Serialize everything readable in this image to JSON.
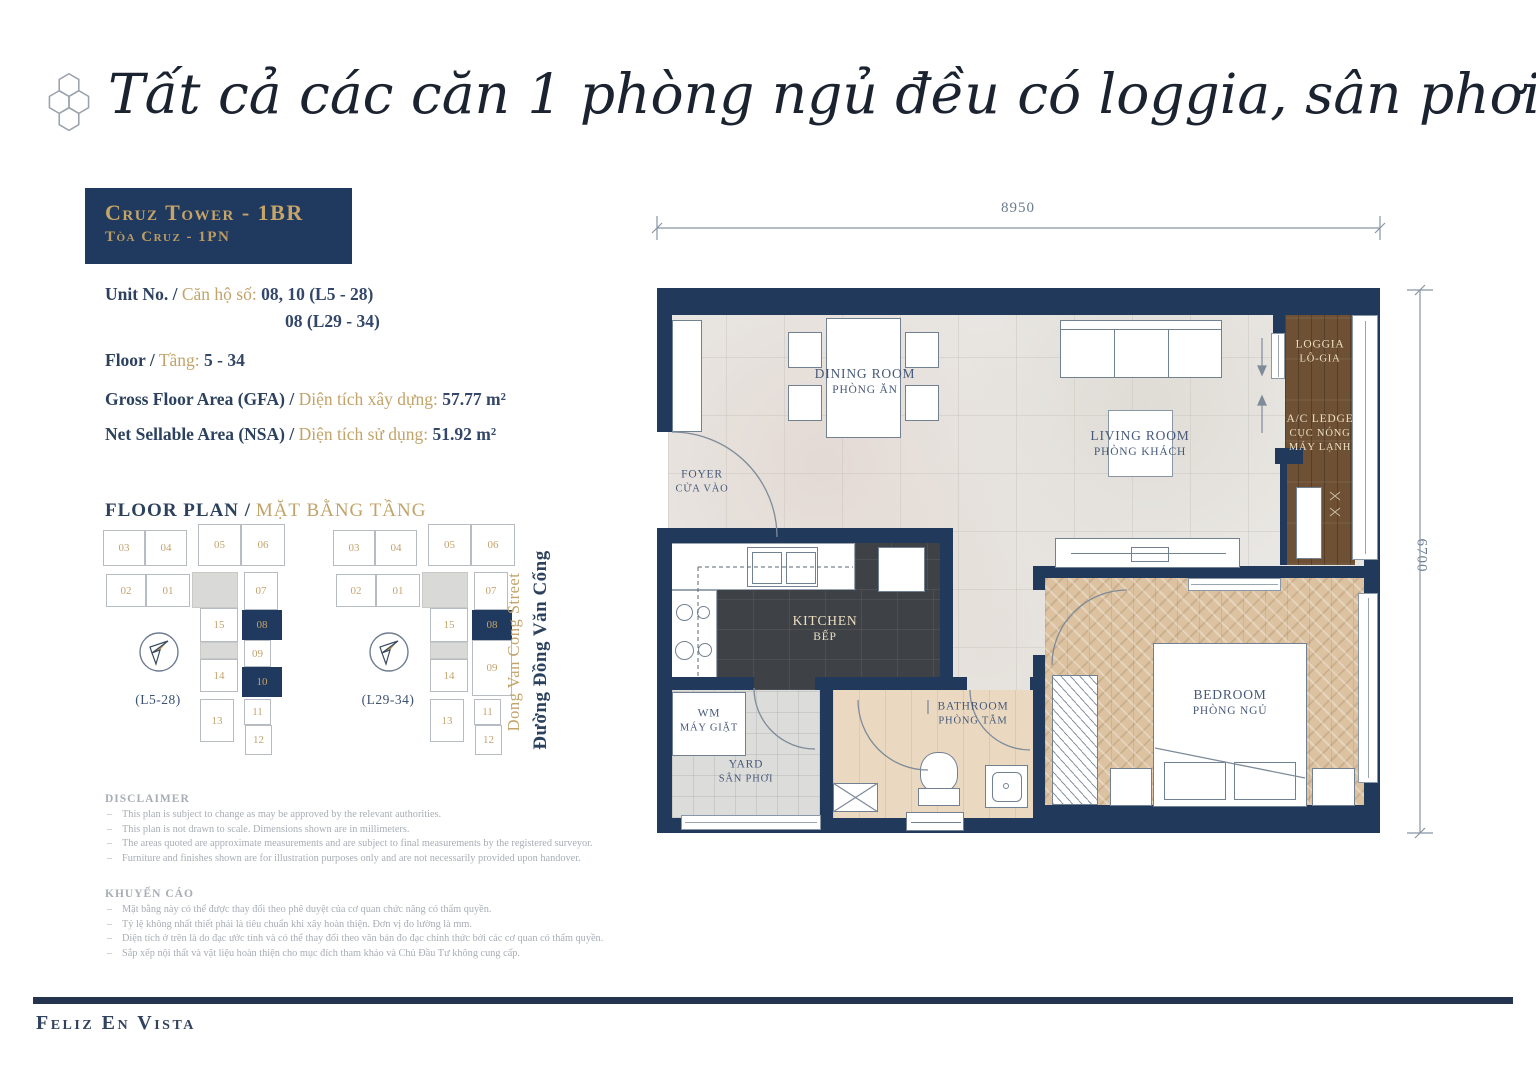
{
  "header": {
    "title": "Tất cả các căn 1 phòng ngủ đều có loggia, sân phơi và bếp kín"
  },
  "unit_card": {
    "tower_en": "Cruz Tower - 1BR",
    "tower_vi": "Tòa Cruz - 1PN",
    "unit_label_en": "Unit No. /",
    "unit_label_vi": "Căn hộ số:",
    "unit_value_1": "08, 10 (L5 - 28)",
    "unit_value_2": "08 (L29 - 34)",
    "floor_label_en": "Floor /",
    "floor_label_vi": "Tầng:",
    "floor_value": "5 - 34",
    "gfa_label_en": "Gross Floor Area (GFA) /",
    "gfa_label_vi": "Diện tích xây dựng:",
    "gfa_value": "57.77 m²",
    "nsa_label_en": "Net Sellable Area (NSA) /",
    "nsa_label_vi": "Diện tích sử dụng:",
    "nsa_value": "51.92 m²"
  },
  "floor_plan": {
    "heading_en": "FLOOR PLAN /",
    "heading_vi": "MẶT BẰNG TẦNG",
    "plan1_label": "(L5-28)",
    "plan2_label": "(L29-34)",
    "units": {
      "u01": "01",
      "u02": "02",
      "u03": "03",
      "u04": "04",
      "u05": "05",
      "u06": "06",
      "u07": "07",
      "u08": "08",
      "u09": "09",
      "u10": "10",
      "u11": "11",
      "u12": "12",
      "u13": "13",
      "u14": "14",
      "u15": "15"
    }
  },
  "street": {
    "en": "Dong Van Cong Street",
    "vi": "Đường Đồng Văn Cống"
  },
  "disclaimer": {
    "heading": "DISCLAIMER",
    "items": [
      "This plan is subject to change as may be approved by the relevant authorities.",
      "This plan is not drawn to scale. Dimensions shown are in millimeters.",
      "The areas quoted are approximate measurements and are subject to final measurements by the registered surveyor.",
      "Furniture and finishes shown are for illustration purposes only and are not necessarily provided upon handover."
    ]
  },
  "advisory": {
    "heading": "KHUYẾN CÁO",
    "items": [
      "Mặt bằng này có thể được thay đổi theo phê duyệt của cơ quan chức năng có thẩm quyền.",
      "Tỷ lệ không nhất thiết phải là tiêu chuẩn khi xây hoàn thiện. Đơn vị đo lường là mm.",
      "Diện tích ở trên là do đạc ước tính và có thể thay đổi theo văn bản đo đạc chính thức bởi các cơ quan có thẩm quyền.",
      "Sắp xếp nội thất và vật liệu hoàn thiện cho mục đích tham khảo và Chủ Đầu Tư không cung cấp."
    ]
  },
  "plan": {
    "dim_width": "8950",
    "dim_height": "6700",
    "rooms": {
      "dining": {
        "en": "DINING ROOM",
        "vi": "PHÒNG ĂN"
      },
      "living": {
        "en": "LIVING ROOM",
        "vi": "PHÒNG KHÁCH"
      },
      "foyer": {
        "en": "FOYER",
        "vi": "CỬA VÀO"
      },
      "kitchen": {
        "en": "KITCHEN",
        "vi": "BẾP"
      },
      "loggia": {
        "en": "LOGGIA",
        "vi": "LÔ-GIA"
      },
      "ac_ledge": {
        "en": "A/C LEDGE",
        "vi": "CỤC NÓNG MÁY LẠNH"
      },
      "wm": {
        "en": "WM",
        "vi": "MÁY GIẶT"
      },
      "yard": {
        "en": "YARD",
        "vi": "SÂN PHƠI"
      },
      "bathroom": {
        "en": "BATHROOM",
        "vi": "PHÒNG TẮM"
      },
      "bedroom": {
        "en": "BEDROOM",
        "vi": "PHÒNG NGỦ"
      }
    }
  },
  "footer": {
    "brand": "Feliz En Vista"
  }
}
